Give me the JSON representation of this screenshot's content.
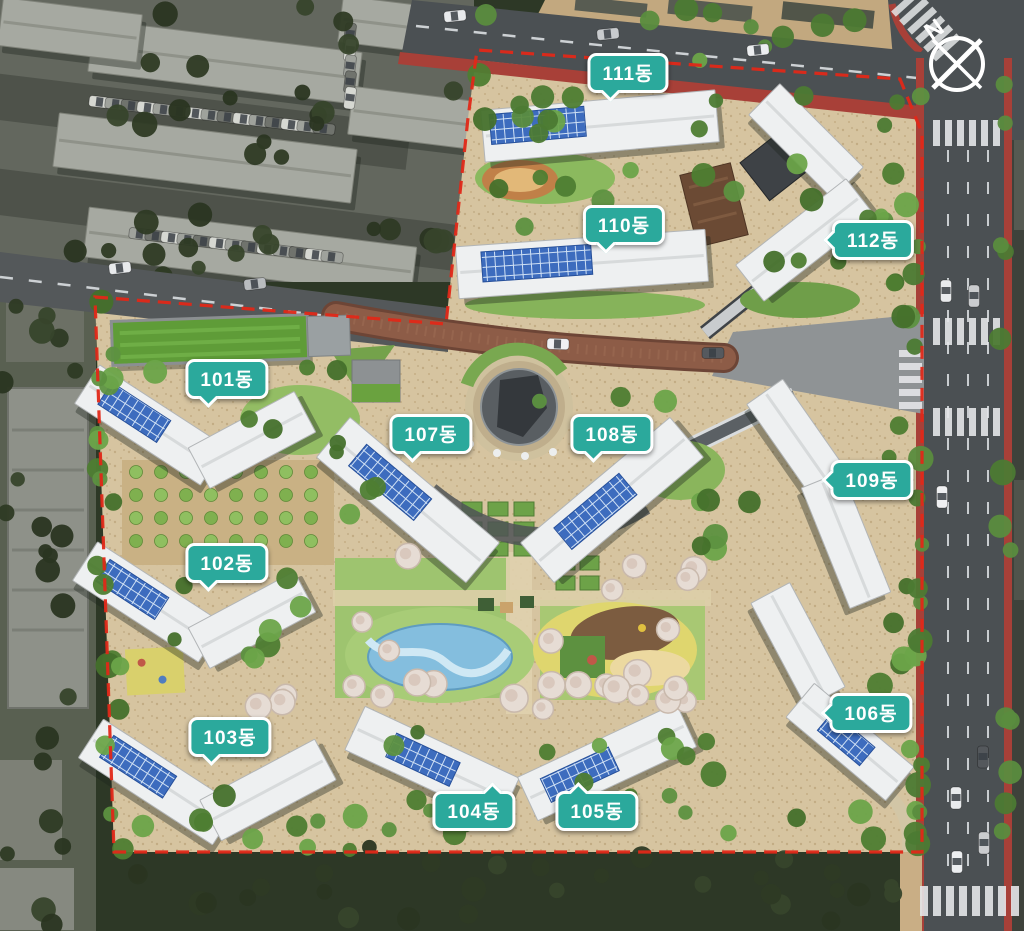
{
  "title": "Apartment complex site plan (aerial rendering)",
  "compass": {
    "label": "N"
  },
  "labels": [
    {
      "id": "101",
      "text": "101동"
    },
    {
      "id": "102",
      "text": "102동"
    },
    {
      "id": "103",
      "text": "103동"
    },
    {
      "id": "104",
      "text": "104동"
    },
    {
      "id": "105",
      "text": "105동"
    },
    {
      "id": "106",
      "text": "106동"
    },
    {
      "id": "107",
      "text": "107동"
    },
    {
      "id": "108",
      "text": "108동"
    },
    {
      "id": "109",
      "text": "109동"
    },
    {
      "id": "110",
      "text": "110동"
    },
    {
      "id": "111",
      "text": "111동"
    },
    {
      "id": "112",
      "text": "112동"
    }
  ],
  "colors": {
    "badge_bg": "#2BA99C",
    "badge_border": "#FFFFFF",
    "badge_text": "#FFFFFF",
    "boundary_red": "#E02818",
    "sidewalk_red": "#A84038",
    "road_gray": "#4B5053",
    "internal_road_brown": "#8D5C47",
    "site_ground_tan": "#D6C4A0",
    "water_blue": "#84BEDE",
    "solar_panel_blue": "#3D6CBE"
  }
}
